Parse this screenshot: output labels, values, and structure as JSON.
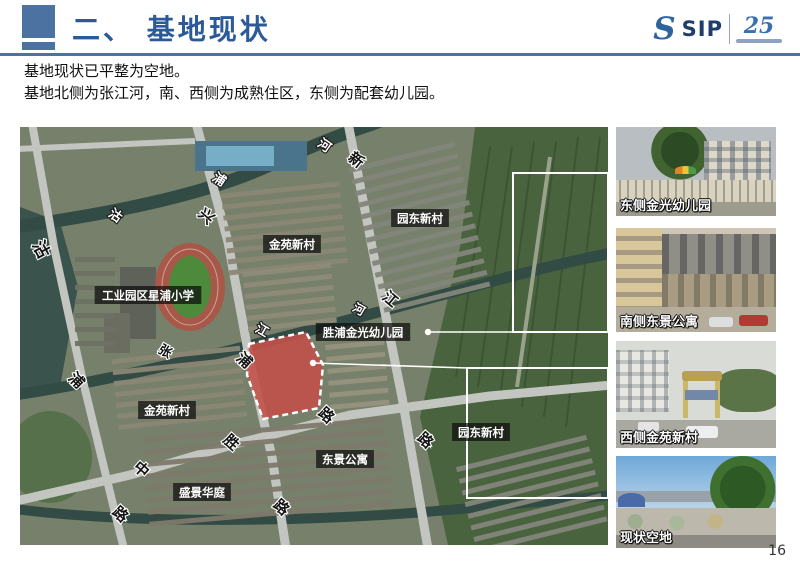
{
  "page": {
    "number": "16"
  },
  "header": {
    "title": "二、 基地现状",
    "accent_color": "#4c72a2",
    "title_color": "#2b5a98",
    "logo": {
      "s_mark": "S",
      "name": "SIP",
      "anniversary": "25"
    }
  },
  "intro": {
    "line1": "基地现状已平整为空地。",
    "line2": "基地北侧为张江河，南、西侧为成熟住区，东侧为配套幼儿园。"
  },
  "map": {
    "site_fill": "#c2504a",
    "outline_color": "#ffffff",
    "labels": [
      {
        "text": "工业园区星浦小学",
        "x": 128,
        "y": 168
      },
      {
        "text": "金苑新村",
        "x": 272,
        "y": 117
      },
      {
        "text": "园东新村",
        "x": 400,
        "y": 91
      },
      {
        "text": "胜浦金光幼儿园",
        "x": 343,
        "y": 205
      },
      {
        "text": "金苑新村",
        "x": 147,
        "y": 283
      },
      {
        "text": "园东新村",
        "x": 461,
        "y": 305
      },
      {
        "text": "东景公寓",
        "x": 325,
        "y": 332
      },
      {
        "text": "盛景华庭",
        "x": 182,
        "y": 365
      }
    ],
    "glyphs": [
      {
        "ch": "沽",
        "x": 16,
        "y": 125,
        "rot": 62,
        "tone": "dark",
        "size": 17
      },
      {
        "ch": "沽",
        "x": 93,
        "y": 92,
        "rot": 35,
        "tone": "light",
        "size": 13
      },
      {
        "ch": "浦",
        "x": 197,
        "y": 56,
        "rot": 33,
        "tone": "light",
        "size": 13
      },
      {
        "ch": "河",
        "x": 302,
        "y": 22,
        "rot": 35,
        "tone": "light",
        "size": 13
      },
      {
        "ch": "兴",
        "x": 183,
        "y": 93,
        "rot": 42,
        "tone": "dark",
        "size": 15
      },
      {
        "ch": "新",
        "x": 333,
        "y": 37,
        "rot": 38,
        "tone": "dark",
        "size": 15
      },
      {
        "ch": "江",
        "x": 367,
        "y": 176,
        "rot": 40,
        "tone": "dark",
        "size": 15
      },
      {
        "ch": "张",
        "x": 143,
        "y": 228,
        "rot": 30,
        "tone": "dark",
        "size": 13
      },
      {
        "ch": "江",
        "x": 240,
        "y": 207,
        "rot": 30,
        "tone": "light",
        "size": 13
      },
      {
        "ch": "河",
        "x": 337,
        "y": 186,
        "rot": 30,
        "tone": "light",
        "size": 12
      },
      {
        "ch": "浦",
        "x": 53,
        "y": 257,
        "rot": 45,
        "tone": "dark",
        "size": 15
      },
      {
        "ch": "浦",
        "x": 221,
        "y": 237,
        "rot": 42,
        "tone": "dark",
        "size": 15
      },
      {
        "ch": "路",
        "x": 303,
        "y": 292,
        "rot": 42,
        "tone": "dark",
        "size": 15
      },
      {
        "ch": "路",
        "x": 402,
        "y": 317,
        "rot": 42,
        "tone": "dark",
        "size": 15
      },
      {
        "ch": "中",
        "x": 118,
        "y": 346,
        "rot": 42,
        "tone": "dark",
        "size": 15
      },
      {
        "ch": "胜",
        "x": 208,
        "y": 319,
        "rot": 42,
        "tone": "dark",
        "size": 15
      },
      {
        "ch": "路",
        "x": 97,
        "y": 391,
        "rot": 42,
        "tone": "dark",
        "size": 15
      },
      {
        "ch": "路",
        "x": 258,
        "y": 384,
        "rot": 42,
        "tone": "dark",
        "size": 15
      }
    ],
    "highlight_boxes": [
      {
        "x": 493,
        "y": 46,
        "w": 95,
        "h": 159
      },
      {
        "x": 447,
        "y": 241,
        "w": 141,
        "h": 130
      }
    ]
  },
  "photos": [
    {
      "caption": "东侧金光幼儿园"
    },
    {
      "caption": "南侧东景公寓"
    },
    {
      "caption": "西侧金苑新村"
    },
    {
      "caption": "现状空地"
    }
  ]
}
